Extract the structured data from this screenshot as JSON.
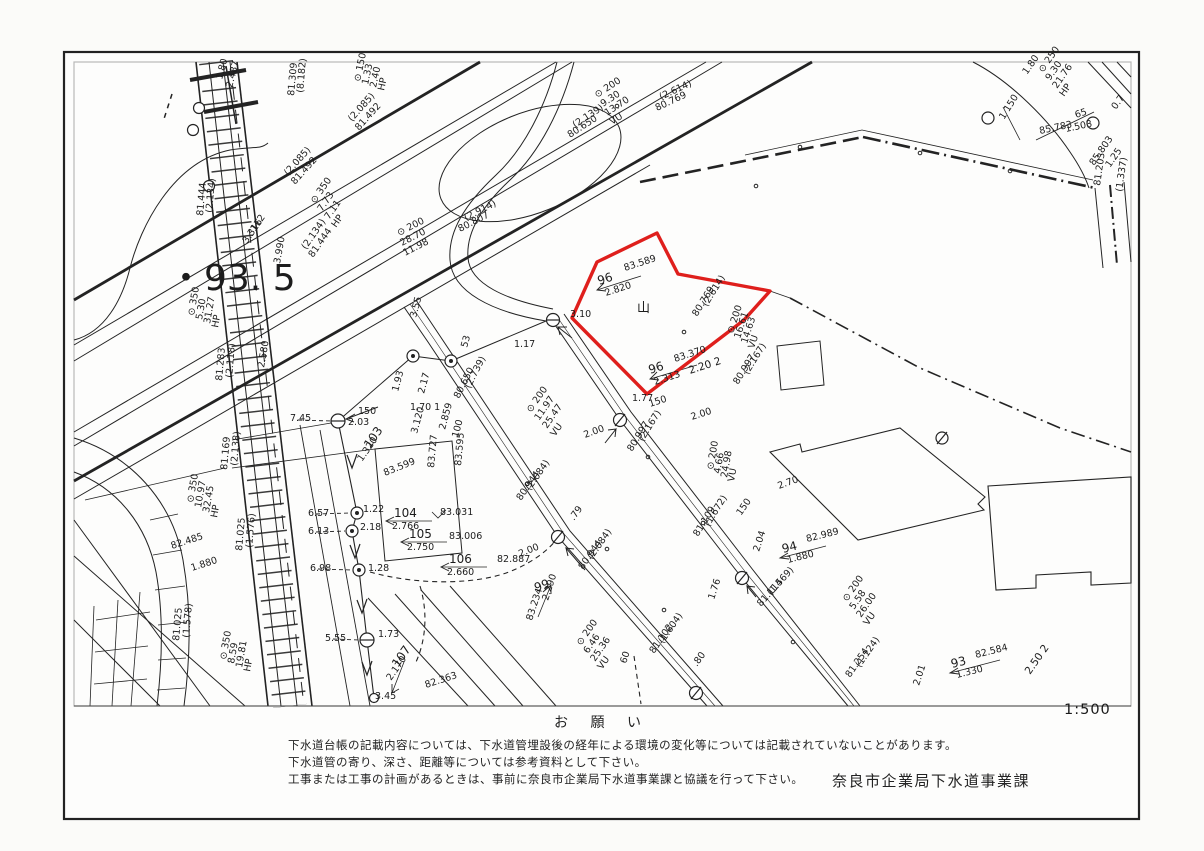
{
  "page": {
    "scale": "1:500"
  },
  "notice": {
    "heading": "お 願 い",
    "lines": [
      "下水道台帳の記載内容については、下水道管埋設後の経年による環境の変化等については記載されていないことがあります。",
      "下水道管の寄り、深さ、距離等については参考資料として下さい。",
      "工事または工事の計画があるときは、事前に奈良市企業局下水道事業課と協議を行って下さい。"
    ],
    "attribution": "奈良市企業局下水道事業課"
  },
  "map": {
    "highlight_color": "#df1f1c",
    "highlight_parcel": {
      "points": "597,262 657,233 678,274 770,291 744,320 647,394 572,318",
      "parcel_numbers": [
        "96",
        "96"
      ],
      "spot_elevations": [
        "83.589",
        "83.370"
      ]
    },
    "block_number": "・93. 5",
    "labels": [
      {
        "t": "⊙ 200",
        "x": 597,
        "y": 98,
        "r": -33
      },
      {
        "t": "9.30",
        "x": 603,
        "y": 107,
        "r": -33
      },
      {
        "t": "13.70",
        "x": 607,
        "y": 116,
        "r": -33
      },
      {
        "t": "VU",
        "x": 612,
        "y": 125,
        "r": -33
      },
      {
        "t": "(2.139)",
        "x": 575,
        "y": 128,
        "r": -33
      },
      {
        "t": "80.650",
        "x": 570,
        "y": 138,
        "r": -33
      },
      {
        "t": "(2.614)",
        "x": 661,
        "y": 100,
        "r": -25
      },
      {
        "t": "80.769",
        "x": 657,
        "y": 111,
        "r": -25
      },
      {
        "t": "⊙ 200",
        "x": 399,
        "y": 236,
        "r": -27
      },
      {
        "t": "28.70",
        "x": 402,
        "y": 246,
        "r": -27
      },
      {
        "t": "11.98",
        "x": 405,
        "y": 256,
        "r": -27
      },
      {
        "t": "(2.914)",
        "x": 466,
        "y": 221,
        "r": -27
      },
      {
        "t": "80.807",
        "x": 460,
        "y": 232,
        "r": -27
      },
      {
        "t": "1.80",
        "x": 222,
        "y": 80,
        "r": -75
      },
      {
        "t": "2.487",
        "x": 232,
        "y": 88,
        "r": -75
      },
      {
        "t": "⊙ 150",
        "x": 360,
        "y": 82,
        "r": -78
      },
      {
        "t": "1.33",
        "x": 368,
        "y": 85,
        "r": -78
      },
      {
        "t": "2.40",
        "x": 376,
        "y": 88,
        "r": -78
      },
      {
        "t": "HP",
        "x": 384,
        "y": 91,
        "r": -78
      },
      {
        "t": "(8.182)",
        "x": 303,
        "y": 93,
        "r": -85
      },
      {
        "t": "81.309",
        "x": 294,
        "y": 96,
        "r": -85
      },
      {
        "t": "(2.085)",
        "x": 352,
        "y": 122,
        "r": -48
      },
      {
        "t": "81.492",
        "x": 359,
        "y": 131,
        "r": -48
      },
      {
        "t": "(2.085)",
        "x": 288,
        "y": 176,
        "r": -48
      },
      {
        "t": "81.492",
        "x": 295,
        "y": 185,
        "r": -48
      },
      {
        "t": "⊙ 350",
        "x": 315,
        "y": 204,
        "r": -55
      },
      {
        "t": "7.73",
        "x": 322,
        "y": 212,
        "r": -55
      },
      {
        "t": "7.11",
        "x": 329,
        "y": 220,
        "r": -55
      },
      {
        "t": "HP",
        "x": 336,
        "y": 228,
        "r": -55
      },
      {
        "t": "(2.134)",
        "x": 306,
        "y": 250,
        "r": -55
      },
      {
        "t": "81.444",
        "x": 313,
        "y": 258,
        "r": -55
      },
      {
        "t": "(2.134)",
        "x": 212,
        "y": 213,
        "r": -85
      },
      {
        "t": "81.444",
        "x": 203,
        "y": 216,
        "r": -85
      },
      {
        "t": "112",
        "x": 255,
        "y": 232,
        "r": -55
      },
      {
        "t": "3.316",
        "x": 247,
        "y": 244,
        "r": -55
      },
      {
        "t": "3.990",
        "x": 280,
        "y": 264,
        "r": -80
      },
      {
        "t": "・93. 5",
        "x": 168,
        "y": 290,
        "s": 36
      },
      {
        "t": "⊙ 350",
        "x": 194,
        "y": 316,
        "r": -80
      },
      {
        "t": "5.30",
        "x": 202,
        "y": 320,
        "r": -80
      },
      {
        "t": "31.27",
        "x": 210,
        "y": 324,
        "r": -80
      },
      {
        "t": "HP",
        "x": 218,
        "y": 328,
        "r": -80
      },
      {
        "t": "2.580",
        "x": 264,
        "y": 368,
        "r": -80
      },
      {
        "t": "(2.118)",
        "x": 232,
        "y": 378,
        "r": -85
      },
      {
        "t": "81.283",
        "x": 222,
        "y": 381,
        "r": -85
      },
      {
        "t": "7.45",
        "x": 290,
        "y": 421
      },
      {
        "t": "150",
        "x": 358,
        "y": 414
      },
      {
        "t": "2.03",
        "x": 348,
        "y": 425
      },
      {
        "t": "(2.138)",
        "x": 237,
        "y": 466,
        "r": -85
      },
      {
        "t": "81.169",
        "x": 227,
        "y": 470,
        "r": -85
      },
      {
        "t": "⊙ 350",
        "x": 193,
        "y": 503,
        "r": -80
      },
      {
        "t": "10.97",
        "x": 201,
        "y": 508,
        "r": -80
      },
      {
        "t": "32.45",
        "x": 209,
        "y": 513,
        "r": -80
      },
      {
        "t": "HP",
        "x": 217,
        "y": 518,
        "r": -80
      },
      {
        "t": "82.485",
        "x": 172,
        "y": 549,
        "r": -18
      },
      {
        "t": "1.880",
        "x": 192,
        "y": 571,
        "r": -18
      },
      {
        "t": "(1.576)",
        "x": 252,
        "y": 548,
        "r": -85
      },
      {
        "t": "81.025",
        "x": 242,
        "y": 551,
        "r": -85
      },
      {
        "t": "6.57",
        "x": 308,
        "y": 516
      },
      {
        "t": "6.13",
        "x": 308,
        "y": 534
      },
      {
        "t": "6.98",
        "x": 310,
        "y": 571
      },
      {
        "t": "5.55",
        "x": 325,
        "y": 641
      },
      {
        "t": "(1.578)",
        "x": 189,
        "y": 638,
        "r": -85
      },
      {
        "t": "81.025",
        "x": 179,
        "y": 641,
        "r": -85
      },
      {
        "t": "⊙ 350",
        "x": 226,
        "y": 660,
        "r": -80
      },
      {
        "t": "8.59",
        "x": 234,
        "y": 664,
        "r": -80
      },
      {
        "t": "19.81",
        "x": 242,
        "y": 668,
        "r": -80
      },
      {
        "t": "HP",
        "x": 250,
        "y": 672,
        "r": -80
      },
      {
        "t": "1.22",
        "x": 363,
        "y": 512
      },
      {
        "t": "2.18",
        "x": 360,
        "y": 530
      },
      {
        "t": "1.28",
        "x": 368,
        "y": 571
      },
      {
        "t": "1.73",
        "x": 378,
        "y": 637
      },
      {
        "t": "103",
        "x": 370,
        "y": 449,
        "r": -55,
        "s": 12
      },
      {
        "t": "1.320",
        "x": 362,
        "y": 462,
        "r": -55
      },
      {
        "t": "83.599",
        "x": 385,
        "y": 476,
        "r": -22
      },
      {
        "t": "83.727",
        "x": 434,
        "y": 468,
        "r": -85
      },
      {
        "t": "83.595",
        "x": 461,
        "y": 466,
        "r": -85
      },
      {
        "t": "104",
        "x": 394,
        "y": 517,
        "s": 12
      },
      {
        "t": "2.766",
        "x": 392,
        "y": 529
      },
      {
        "t": "83.031",
        "x": 440,
        "y": 515
      },
      {
        "t": "105",
        "x": 409,
        "y": 538,
        "s": 12
      },
      {
        "t": "2.750",
        "x": 407,
        "y": 550
      },
      {
        "t": "83.006",
        "x": 449,
        "y": 539
      },
      {
        "t": "106",
        "x": 449,
        "y": 563,
        "s": 12
      },
      {
        "t": "2.660",
        "x": 447,
        "y": 575
      },
      {
        "t": "82.887",
        "x": 497,
        "y": 562
      },
      {
        "t": "107",
        "x": 398,
        "y": 668,
        "r": -55,
        "s": 12
      },
      {
        "t": "2.170",
        "x": 391,
        "y": 681,
        "r": -55
      },
      {
        "t": "82.363",
        "x": 426,
        "y": 688,
        "r": -18
      },
      {
        "t": "3.45",
        "x": 375,
        "y": 699
      },
      {
        "t": "1.93",
        "x": 398,
        "y": 392,
        "r": -75
      },
      {
        "t": "2.17",
        "x": 424,
        "y": 394,
        "r": -75
      },
      {
        "t": "1.70  1",
        "x": 410,
        "y": 410
      },
      {
        "t": "3.55",
        "x": 416,
        "y": 318,
        "r": -75
      },
      {
        "t": "53",
        "x": 467,
        "y": 348,
        "r": -75
      },
      {
        "t": "1.17",
        "x": 514,
        "y": 347
      },
      {
        "t": "3.120",
        "x": 417,
        "y": 434,
        "r": -75
      },
      {
        "t": "2.859",
        "x": 445,
        "y": 430,
        "r": -75
      },
      {
        "t": "100",
        "x": 458,
        "y": 438,
        "r": -75
      },
      {
        "t": "(2.739)",
        "x": 470,
        "y": 389,
        "r": -63
      },
      {
        "t": "80.650",
        "x": 459,
        "y": 399,
        "r": -63
      },
      {
        "t": "⊙ 200",
        "x": 531,
        "y": 413,
        "r": -55
      },
      {
        "t": "11.97",
        "x": 539,
        "y": 421,
        "r": -55
      },
      {
        "t": "25.47",
        "x": 547,
        "y": 429,
        "r": -55
      },
      {
        "t": "VU",
        "x": 555,
        "y": 437,
        "r": -55
      },
      {
        "t": "2.00",
        "x": 585,
        "y": 438,
        "r": -20
      },
      {
        "t": "(2.084)",
        "x": 530,
        "y": 491,
        "r": -55
      },
      {
        "t": "80.944",
        "x": 521,
        "y": 501,
        "r": -55
      },
      {
        "t": ".79",
        "x": 574,
        "y": 521,
        "r": -55
      },
      {
        "t": "2.00",
        "x": 520,
        "y": 557,
        "r": -22
      },
      {
        "t": "(2.084)",
        "x": 592,
        "y": 560,
        "r": -55
      },
      {
        "t": "80.944",
        "x": 583,
        "y": 570,
        "r": -55
      },
      {
        "t": "99",
        "x": 536,
        "y": 592,
        "r": -20,
        "s": 12
      },
      {
        "t": "2.290",
        "x": 548,
        "y": 601,
        "r": -72
      },
      {
        "t": "83.234",
        "x": 532,
        "y": 621,
        "r": -72
      },
      {
        "t": "⊙ 200",
        "x": 581,
        "y": 646,
        "r": -55
      },
      {
        "t": "6.46",
        "x": 588,
        "y": 654,
        "r": -55
      },
      {
        "t": "25.36",
        "x": 595,
        "y": 662,
        "r": -55
      },
      {
        "t": "VU",
        "x": 602,
        "y": 670,
        "r": -55
      },
      {
        "t": "60",
        "x": 626,
        "y": 664,
        "r": -72
      },
      {
        "t": "(1.604)",
        "x": 663,
        "y": 644,
        "r": -55
      },
      {
        "t": "81.102",
        "x": 654,
        "y": 654,
        "r": -55
      },
      {
        "t": ".80",
        "x": 697,
        "y": 667,
        "r": -55
      },
      {
        "t": "96",
        "x": 599,
        "y": 285,
        "r": -18,
        "s": 12
      },
      {
        "t": "83.589",
        "x": 625,
        "y": 271,
        "r": -18
      },
      {
        "t": "2.820",
        "x": 606,
        "y": 296,
        "r": -18
      },
      {
        "t": "3.10",
        "x": 570,
        "y": 317
      },
      {
        "t": "山",
        "x": 637,
        "y": 312,
        "s": 13
      },
      {
        "t": "96",
        "x": 650,
        "y": 374,
        "r": -18,
        "s": 12
      },
      {
        "t": "83.370",
        "x": 675,
        "y": 362,
        "r": -18
      },
      {
        "t": "2.313",
        "x": 655,
        "y": 385,
        "r": -18
      },
      {
        "t": "2.20 2",
        "x": 690,
        "y": 374,
        "r": -18,
        "s": 10.5
      },
      {
        "t": "(2.614)",
        "x": 707,
        "y": 307,
        "r": -58
      },
      {
        "t": "80.769",
        "x": 697,
        "y": 317,
        "r": -58
      },
      {
        "t": "⊙ 200",
        "x": 733,
        "y": 334,
        "r": -72
      },
      {
        "t": "16.61",
        "x": 740,
        "y": 339,
        "r": -72
      },
      {
        "t": "14.63",
        "x": 747,
        "y": 344,
        "r": -72
      },
      {
        "t": "VU",
        "x": 754,
        "y": 349,
        "r": -72
      },
      {
        "t": "(2.167)",
        "x": 748,
        "y": 375,
        "r": -58
      },
      {
        "t": "80.997",
        "x": 738,
        "y": 385,
        "r": -58
      },
      {
        "t": "1.77",
        "x": 632,
        "y": 401
      },
      {
        "t": "150",
        "x": 650,
        "y": 407,
        "r": -18
      },
      {
        "t": "2.00",
        "x": 692,
        "y": 420,
        "r": -18
      },
      {
        "t": "(2.167)",
        "x": 643,
        "y": 442,
        "r": -58
      },
      {
        "t": "80.997",
        "x": 632,
        "y": 452,
        "r": -58
      },
      {
        "t": "⊙ 200",
        "x": 713,
        "y": 470,
        "r": -80
      },
      {
        "t": "4.66",
        "x": 720,
        "y": 474,
        "r": -80
      },
      {
        "t": "24.98",
        "x": 727,
        "y": 478,
        "r": -80
      },
      {
        "t": "VU",
        "x": 734,
        "y": 482,
        "r": -80
      },
      {
        "t": "150",
        "x": 741,
        "y": 516,
        "r": -55
      },
      {
        "t": "2.70",
        "x": 779,
        "y": 489,
        "r": -20
      },
      {
        "t": "94",
        "x": 783,
        "y": 553,
        "r": -14,
        "s": 12
      },
      {
        "t": "82.989",
        "x": 807,
        "y": 542,
        "r": -14
      },
      {
        "t": "1.880",
        "x": 788,
        "y": 563,
        "r": -14
      },
      {
        "t": "2.04",
        "x": 759,
        "y": 552,
        "r": -72
      },
      {
        "t": "(1.672)",
        "x": 709,
        "y": 527,
        "r": -58
      },
      {
        "t": "81.109",
        "x": 698,
        "y": 537,
        "r": -58
      },
      {
        "t": "(1.569)",
        "x": 771,
        "y": 596,
        "r": -48
      },
      {
        "t": "81.114",
        "x": 761,
        "y": 607,
        "r": -48
      },
      {
        "t": "1.76",
        "x": 714,
        "y": 600,
        "r": -72
      },
      {
        "t": "⊙ 200",
        "x": 847,
        "y": 602,
        "r": -55
      },
      {
        "t": "5.58",
        "x": 854,
        "y": 610,
        "r": -55
      },
      {
        "t": "26.00",
        "x": 861,
        "y": 618,
        "r": -55
      },
      {
        "t": "VU",
        "x": 868,
        "y": 626,
        "r": -55
      },
      {
        "t": "(1.124)",
        "x": 860,
        "y": 668,
        "r": -55
      },
      {
        "t": "81.254",
        "x": 850,
        "y": 678,
        "r": -55
      },
      {
        "t": "2.01",
        "x": 919,
        "y": 686,
        "r": -72
      },
      {
        "t": "93",
        "x": 952,
        "y": 668,
        "r": -14,
        "s": 12
      },
      {
        "t": "82.584",
        "x": 976,
        "y": 658,
        "r": -14
      },
      {
        "t": "1.330",
        "x": 957,
        "y": 678,
        "r": -14
      },
      {
        "t": "2.50 2",
        "x": 1030,
        "y": 675,
        "r": -55,
        "s": 10.5
      },
      {
        "t": "1.80",
        "x": 1027,
        "y": 75,
        "r": -55
      },
      {
        "t": "⊙ 250",
        "x": 1043,
        "y": 73,
        "r": -55
      },
      {
        "t": "9.30",
        "x": 1050,
        "y": 81,
        "r": -55
      },
      {
        "t": "21.76",
        "x": 1057,
        "y": 89,
        "r": -55
      },
      {
        "t": "HP",
        "x": 1064,
        "y": 97,
        "r": -55
      },
      {
        "t": "1 150",
        "x": 1004,
        "y": 120,
        "r": -58
      },
      {
        "t": "65",
        "x": 1076,
        "y": 118,
        "r": -18
      },
      {
        "t": "85.783",
        "x": 1040,
        "y": 134,
        "r": -12
      },
      {
        "t": "1.503",
        "x": 1066,
        "y": 132,
        "r": -12
      },
      {
        "t": "85.803",
        "x": 1094,
        "y": 166,
        "r": -55
      },
      {
        "t": "1.25",
        "x": 1110,
        "y": 168,
        "r": -55
      },
      {
        "t": "0.7",
        "x": 1116,
        "y": 110,
        "r": -55
      },
      {
        "t": "81.203",
        "x": 1100,
        "y": 186,
        "r": -82
      },
      {
        "t": "(1.337)",
        "x": 1122,
        "y": 192,
        "r": -82
      }
    ]
  }
}
